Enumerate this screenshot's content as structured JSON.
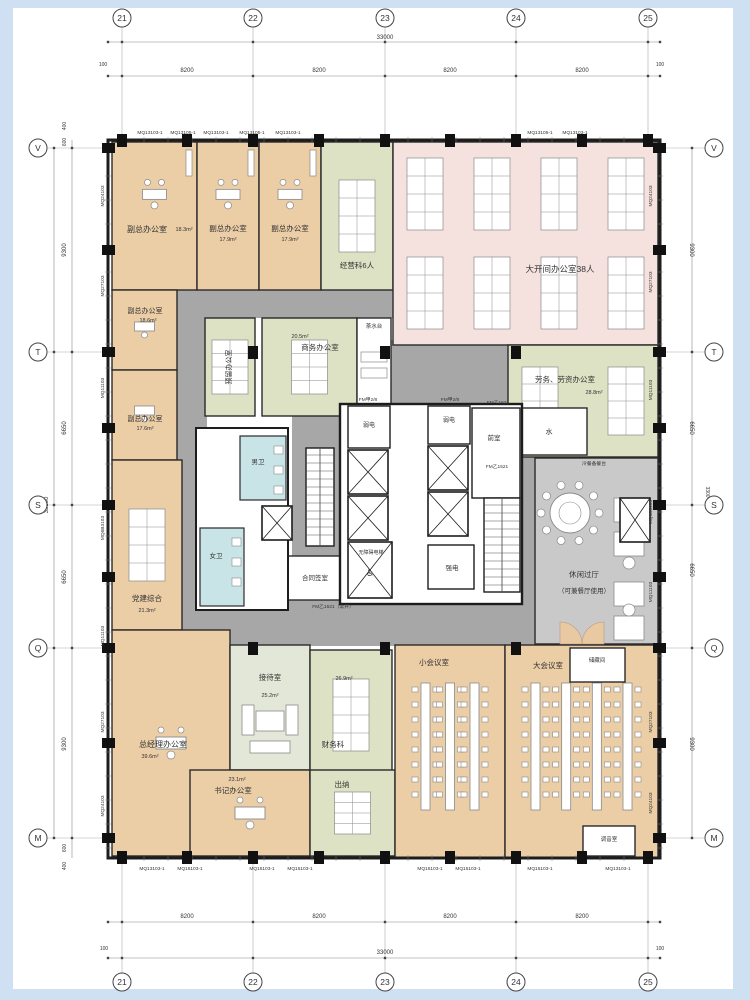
{
  "drawing": {
    "type": "architectural-floor-plan",
    "total_width_mm": "33000",
    "total_height_mm": "33100"
  },
  "colors": {
    "frame": "#cfe0f2",
    "sheet": "#ffffff",
    "wall": "#1d1d1d",
    "corridor": "#a7a7a7",
    "peach": "#ebcda6",
    "pink": "#f5e2df",
    "green": "#dce2c3",
    "sage": "#e3e7d7",
    "cyan": "#c9e4e7",
    "lightgray": "#c9c9c9",
    "white": "#ffffff",
    "dim": "#555555",
    "furn_stroke": "#8a8a8a",
    "door": "#e8c9a2"
  },
  "grid": {
    "cols": [
      {
        "l": "21",
        "x": 122
      },
      {
        "l": "22",
        "x": 253
      },
      {
        "l": "23",
        "x": 385
      },
      {
        "l": "24",
        "x": 516
      },
      {
        "l": "25",
        "x": 648
      }
    ],
    "rows": [
      {
        "l": "V",
        "y": 148
      },
      {
        "l": "T",
        "y": 352
      },
      {
        "l": "S",
        "y": 505
      },
      {
        "l": "Q",
        "y": 648
      },
      {
        "l": "M",
        "y": 838
      }
    ],
    "building": {
      "x": 108,
      "y": 140,
      "w": 552,
      "h": 718
    }
  },
  "dim_texts": [
    {
      "t": "33000",
      "x": 385,
      "y": 39,
      "s": 6
    },
    {
      "t": "100",
      "x": 103,
      "y": 66,
      "s": 5
    },
    {
      "t": "8200",
      "x": 187,
      "y": 72,
      "s": 6
    },
    {
      "t": "8200",
      "x": 319,
      "y": 72,
      "s": 6
    },
    {
      "t": "8200",
      "x": 450,
      "y": 72,
      "s": 6
    },
    {
      "t": "8200",
      "x": 582,
      "y": 72,
      "s": 6
    },
    {
      "t": "100",
      "x": 660,
      "y": 66,
      "s": 5
    },
    {
      "t": "8200",
      "x": 187,
      "y": 918,
      "s": 6
    },
    {
      "t": "8200",
      "x": 319,
      "y": 918,
      "s": 6
    },
    {
      "t": "8200",
      "x": 450,
      "y": 918,
      "s": 6
    },
    {
      "t": "8200",
      "x": 582,
      "y": 918,
      "s": 6
    },
    {
      "t": "33000",
      "x": 385,
      "y": 954,
      "s": 6
    },
    {
      "t": "100",
      "x": 104,
      "y": 950,
      "s": 5
    },
    {
      "t": "100",
      "x": 660,
      "y": 950,
      "s": 5
    },
    {
      "t": "400",
      "x": 66,
      "y": 126,
      "s": 5,
      "r": -90
    },
    {
      "t": "600",
      "x": 66,
      "y": 142,
      "s": 5,
      "r": -90
    },
    {
      "t": "9300",
      "x": 66,
      "y": 250,
      "s": 6,
      "r": -90
    },
    {
      "t": "6650",
      "x": 66,
      "y": 428,
      "s": 6,
      "r": -90
    },
    {
      "t": "6650",
      "x": 66,
      "y": 577,
      "s": 6,
      "r": -90
    },
    {
      "t": "9300",
      "x": 66,
      "y": 744,
      "s": 6,
      "r": -90
    },
    {
      "t": "600",
      "x": 66,
      "y": 848,
      "s": 5,
      "r": -90
    },
    {
      "t": "400",
      "x": 66,
      "y": 866,
      "s": 5,
      "r": -90
    },
    {
      "t": "33100",
      "x": 48,
      "y": 505,
      "s": 6,
      "r": -90
    },
    {
      "t": "9300",
      "x": 690,
      "y": 250,
      "s": 6,
      "r": 90
    },
    {
      "t": "6650",
      "x": 690,
      "y": 428,
      "s": 6,
      "r": 90
    },
    {
      "t": "3300",
      "x": 706,
      "y": 492,
      "s": 5,
      "r": 90
    },
    {
      "t": "6650",
      "x": 690,
      "y": 570,
      "s": 6,
      "r": 90
    },
    {
      "t": "9300",
      "x": 690,
      "y": 744,
      "s": 6,
      "r": 90
    }
  ],
  "window_tags": {
    "top": [
      {
        "t": "MQ13103-1",
        "x": 150
      },
      {
        "t": "MQ13105-1",
        "x": 183
      },
      {
        "t": "MQ13103-1",
        "x": 216
      },
      {
        "t": "MQ13105-1",
        "x": 252
      },
      {
        "t": "MQ13103-1",
        "x": 288
      },
      {
        "t": "MQ13105-1",
        "x": 540
      },
      {
        "t": "MQ13103-1",
        "x": 575
      }
    ],
    "bottom": [
      {
        "t": "MQ13103-1",
        "x": 152
      },
      {
        "t": "MQ15103-1",
        "x": 190
      },
      {
        "t": "MQ15103-1",
        "x": 262
      },
      {
        "t": "MQ15103-1",
        "x": 300
      },
      {
        "t": "MQ15103-1",
        "x": 430
      },
      {
        "t": "MQ15103-1",
        "x": 468
      },
      {
        "t": "MQ15103-1",
        "x": 540
      },
      {
        "t": "MQ13103-1",
        "x": 618
      }
    ],
    "left": [
      {
        "t": "MQ24103",
        "y": 196
      },
      {
        "t": "MQ27103",
        "y": 286
      },
      {
        "t": "MQ11103",
        "y": 388
      },
      {
        "t": "MQ6B3103",
        "y": 528
      },
      {
        "t": "MQ11103",
        "y": 636
      },
      {
        "t": "MQ27103",
        "y": 722
      },
      {
        "t": "MQ24103",
        "y": 806
      }
    ],
    "right": [
      {
        "t": "MQ24103",
        "y": 196
      },
      {
        "t": "MQ27103",
        "y": 282
      },
      {
        "t": "MQ11103",
        "y": 390
      },
      {
        "t": "MQ6B3103",
        "y": 512
      },
      {
        "t": "MQ11103",
        "y": 592
      },
      {
        "t": "MQ27103",
        "y": 722
      },
      {
        "t": "MQ24103",
        "y": 803
      }
    ]
  },
  "corridors": [
    {
      "x": 175,
      "y": 286,
      "w": 333,
      "h": 32
    },
    {
      "x": 177,
      "y": 286,
      "w": 30,
      "h": 350
    },
    {
      "x": 205,
      "y": 598,
      "w": 330,
      "h": 48
    },
    {
      "x": 390,
      "y": 340,
      "w": 44,
      "h": 266
    },
    {
      "x": 433,
      "y": 345,
      "w": 75,
      "h": 61
    },
    {
      "x": 292,
      "y": 406,
      "w": 48,
      "h": 196
    },
    {
      "x": 520,
      "y": 457,
      "w": 15,
      "h": 141
    }
  ],
  "rooms": [
    {
      "id": "fuzong-a",
      "f": "peach",
      "x": 112,
      "y": 142,
      "w": 85,
      "h": 148,
      "furn": "exec",
      "labels": [
        {
          "t": "副总办公室",
          "x": 147,
          "y": 232,
          "s": 8
        },
        {
          "t": "18.3m²",
          "x": 184,
          "y": 231,
          "s": 5.5
        }
      ]
    },
    {
      "id": "fuzong-b",
      "f": "peach",
      "x": 197,
      "y": 142,
      "w": 62,
      "h": 148,
      "furn": "exec",
      "labels": [
        {
          "t": "副总办公室",
          "x": 228,
          "y": 231,
          "s": 7.5
        },
        {
          "t": "17.9m²",
          "x": 228,
          "y": 241,
          "s": 5.5
        }
      ]
    },
    {
      "id": "fuzong-c",
      "f": "peach",
      "x": 259,
      "y": 142,
      "w": 62,
      "h": 148,
      "furn": "exec",
      "labels": [
        {
          "t": "副总办公室",
          "x": 290,
          "y": 231,
          "s": 7.5
        },
        {
          "t": "17.9m²",
          "x": 290,
          "y": 241,
          "s": 5.5
        }
      ]
    },
    {
      "id": "jingyingke",
      "f": "green",
      "x": 321,
      "y": 142,
      "w": 72,
      "h": 148,
      "furn": "ws",
      "labels": [
        {
          "t": "经营科6人",
          "x": 357,
          "y": 268,
          "s": 7.5
        }
      ]
    },
    {
      "id": "dakaijian",
      "f": "pink",
      "x": 393,
      "y": 142,
      "w": 265,
      "h": 203,
      "furn": "ws",
      "labels": [
        {
          "t": "大开间办公室38人",
          "x": 560,
          "y": 272,
          "s": 8.5
        }
      ]
    },
    {
      "id": "fuzong-d",
      "f": "peach",
      "x": 112,
      "y": 290,
      "w": 65,
      "h": 80,
      "furn": "exec2",
      "labels": [
        {
          "t": "副总办公室",
          "x": 145,
          "y": 313,
          "s": 7
        },
        {
          "t": "18.6m²",
          "x": 148,
          "y": 322,
          "s": 5.5
        }
      ]
    },
    {
      "id": "fuzong-e",
      "f": "peach",
      "x": 112,
      "y": 370,
      "w": 65,
      "h": 90,
      "furn": "exec2",
      "labels": [
        {
          "t": "副总办公室",
          "x": 145,
          "y": 421,
          "s": 7
        },
        {
          "t": "17.6m²",
          "x": 145,
          "y": 430,
          "s": 5.5
        }
      ]
    },
    {
      "id": "yuliu",
      "f": "green",
      "x": 205,
      "y": 318,
      "w": 50,
      "h": 98,
      "furn": "ws",
      "labels": [
        {
          "t": "预留办公室",
          "x": 231,
          "y": 367,
          "s": 7,
          "r": -90
        }
      ]
    },
    {
      "id": "shangwu",
      "f": "green",
      "x": 262,
      "y": 318,
      "w": 95,
      "h": 98,
      "furn": "ws",
      "labels": [
        {
          "t": "20.5m²",
          "x": 300,
          "y": 338,
          "s": 5.5
        },
        {
          "t": "商务办公室",
          "x": 320,
          "y": 350,
          "s": 7.5
        }
      ]
    },
    {
      "id": "chashuitai",
      "f": "white",
      "x": 357,
      "y": 318,
      "w": 34,
      "h": 87,
      "furn": "tea",
      "labels": [
        {
          "t": "茶水台",
          "x": 374,
          "y": 328,
          "s": 5.5
        }
      ]
    },
    {
      "id": "laowu",
      "f": "green",
      "x": 508,
      "y": 345,
      "w": 150,
      "h": 112,
      "furn": "ws",
      "labels": [
        {
          "t": "劳务、劳资办公室",
          "x": 565,
          "y": 382,
          "s": 7.5
        },
        {
          "t": "28.8m²",
          "x": 594,
          "y": 394,
          "s": 5.5
        }
      ]
    },
    {
      "id": "shui",
      "f": "white",
      "x": 512,
      "y": 408,
      "w": 75,
      "h": 47,
      "furn": null,
      "labels": [
        {
          "t": "水",
          "x": 549,
          "y": 434,
          "s": 7
        }
      ]
    },
    {
      "id": "dangjian",
      "f": "peach",
      "x": 112,
      "y": 460,
      "w": 70,
      "h": 170,
      "furn": "ws",
      "labels": [
        {
          "t": "党建综合",
          "x": 147,
          "y": 601,
          "s": 7.5
        },
        {
          "t": "21.3m²",
          "x": 147,
          "y": 612,
          "s": 5.5
        }
      ]
    },
    {
      "id": "hetong",
      "f": "white",
      "x": 286,
      "y": 556,
      "w": 58,
      "h": 44,
      "furn": null,
      "labels": [
        {
          "t": "合同签室",
          "x": 315,
          "y": 580,
          "s": 6.5
        }
      ]
    },
    {
      "id": "nvwei",
      "f": "cyan",
      "x": 200,
      "y": 528,
      "w": 44,
      "h": 78,
      "furn": "wc",
      "labels": [
        {
          "t": "女卫",
          "x": 216,
          "y": 558,
          "s": 6.5
        }
      ]
    },
    {
      "id": "nanwei",
      "f": "cyan",
      "x": 240,
      "y": 436,
      "w": 46,
      "h": 64,
      "furn": "wc",
      "labels": [
        {
          "t": "男卫",
          "x": 258,
          "y": 464,
          "s": 6.5
        }
      ]
    },
    {
      "id": "xiuxian",
      "f": "lightgray",
      "x": 535,
      "y": 458,
      "w": 123,
      "h": 186,
      "furn": "lounge",
      "labels": [
        {
          "t": "休闲过厅",
          "x": 584,
          "y": 577,
          "s": 7.5
        },
        {
          "t": "（可兼餐厅使用）",
          "x": 584,
          "y": 593,
          "s": 6.5
        }
      ]
    },
    {
      "id": "zongjingli",
      "f": "peach",
      "x": 112,
      "y": 630,
      "w": 118,
      "h": 226,
      "furn": "bigdesk",
      "labels": [
        {
          "t": "总经理办公室",
          "x": 163,
          "y": 747,
          "s": 8
        },
        {
          "t": "39.6m²",
          "x": 150,
          "y": 758,
          "s": 5.5
        }
      ]
    },
    {
      "id": "jiedai",
      "f": "sage",
      "x": 230,
      "y": 645,
      "w": 80,
      "h": 125,
      "furn": "recept",
      "labels": [
        {
          "t": "接待室",
          "x": 270,
          "y": 680,
          "s": 7.5
        },
        {
          "t": "25.2m²",
          "x": 270,
          "y": 697,
          "s": 5.5
        }
      ]
    },
    {
      "id": "shuji",
      "f": "peach",
      "x": 190,
      "y": 770,
      "w": 120,
      "h": 86,
      "furn": "bigdesk",
      "labels": [
        {
          "t": "23.1m²",
          "x": 237,
          "y": 781,
          "s": 5.5
        },
        {
          "t": "书记办公室",
          "x": 233,
          "y": 793,
          "s": 7.5
        }
      ]
    },
    {
      "id": "caiwu",
      "f": "green",
      "x": 310,
      "y": 650,
      "w": 82,
      "h": 130,
      "furn": "ws",
      "labels": [
        {
          "t": "26.9m²",
          "x": 344,
          "y": 680,
          "s": 5.5
        },
        {
          "t": "财务科",
          "x": 333,
          "y": 747,
          "s": 7.5
        }
      ]
    },
    {
      "id": "chuna",
      "f": "green",
      "x": 310,
      "y": 770,
      "w": 85,
      "h": 86,
      "furn": "ws",
      "labels": [
        {
          "t": "出纳",
          "x": 342,
          "y": 787,
          "s": 7.5
        }
      ]
    },
    {
      "id": "xiaohuiyishi",
      "f": "peach",
      "x": 395,
      "y": 645,
      "w": 110,
      "h": 213,
      "furn": "meeting",
      "labels": [
        {
          "t": "小会议室",
          "x": 434,
          "y": 665,
          "s": 7.5
        }
      ]
    },
    {
      "id": "dahuiyishi",
      "f": "peach",
      "x": 505,
      "y": 645,
      "w": 153,
      "h": 213,
      "furn": "meeting",
      "labels": [
        {
          "t": "大会议室",
          "x": 548,
          "y": 668,
          "s": 7.5
        }
      ]
    },
    {
      "id": "chucang",
      "f": "white",
      "x": 570,
      "y": 648,
      "w": 55,
      "h": 34,
      "furn": null,
      "labels": [
        {
          "t": "储藏间",
          "x": 597,
          "y": 662,
          "s": 5.5
        }
      ]
    },
    {
      "id": "tiaoyin",
      "f": "white",
      "x": 583,
      "y": 826,
      "w": 52,
      "h": 30,
      "furn": null,
      "labels": [
        {
          "t": "调音室",
          "x": 609,
          "y": 841,
          "s": 5.5
        }
      ]
    }
  ],
  "core": {
    "outline": {
      "x": 340,
      "y": 404,
      "w": 182,
      "h": 200
    },
    "toilet_outline": {
      "x": 196,
      "y": 428,
      "w": 92,
      "h": 182
    },
    "white_rooms": [
      {
        "x": 348,
        "y": 406,
        "w": 42,
        "h": 42
      },
      {
        "x": 428,
        "y": 406,
        "w": 42,
        "h": 38
      },
      {
        "x": 472,
        "y": 408,
        "w": 48,
        "h": 90
      },
      {
        "x": 428,
        "y": 545,
        "w": 46,
        "h": 44
      }
    ],
    "elevators": [
      {
        "x": 348,
        "y": 450,
        "w": 40,
        "h": 44
      },
      {
        "x": 348,
        "y": 496,
        "w": 40,
        "h": 44
      },
      {
        "x": 428,
        "y": 446,
        "w": 40,
        "h": 44
      },
      {
        "x": 428,
        "y": 492,
        "w": 40,
        "h": 44
      },
      {
        "x": 262,
        "y": 506,
        "w": 30,
        "h": 34
      },
      {
        "x": 620,
        "y": 498,
        "w": 30,
        "h": 44
      },
      {
        "x": 348,
        "y": 542,
        "w": 44,
        "h": 56,
        "accessible": true
      }
    ],
    "stairs": [
      {
        "x": 306,
        "y": 448,
        "w": 28,
        "h": 98
      },
      {
        "x": 484,
        "y": 498,
        "w": 36,
        "h": 94
      }
    ],
    "labels": [
      {
        "t": "FM甲2/8",
        "x": 368,
        "y": 401,
        "s": 4.8
      },
      {
        "t": "弱电",
        "x": 369,
        "y": 427,
        "s": 6
      },
      {
        "t": "FM甲2/8",
        "x": 450,
        "y": 401,
        "s": 4.8
      },
      {
        "t": "弱电",
        "x": 449,
        "y": 422,
        "s": 6
      },
      {
        "t": "FM乙1521",
        "x": 498,
        "y": 404,
        "s": 4.8
      },
      {
        "t": "前室",
        "x": 494,
        "y": 440,
        "s": 6.5
      },
      {
        "t": "FM乙1521",
        "x": 497,
        "y": 468,
        "s": 4.8
      },
      {
        "t": "强电",
        "x": 452,
        "y": 570,
        "s": 6.5
      },
      {
        "t": "无障碍电梯",
        "x": 371,
        "y": 554,
        "s": 5
      },
      {
        "t": "♿",
        "x": 370,
        "y": 576,
        "s": 9
      },
      {
        "t": "FM乙1521（常开）",
        "x": 333,
        "y": 608,
        "s": 4.8
      },
      {
        "t": "冷餐备餐台",
        "x": 594,
        "y": 465,
        "s": 4.8
      }
    ]
  },
  "doors_double": [
    {
      "x": 560,
      "y": 644
    },
    {
      "x": 604,
      "y": 644
    }
  ],
  "interior_columns": [
    {
      "x": 253,
      "y": 352
    },
    {
      "x": 385,
      "y": 352
    },
    {
      "x": 516,
      "y": 352
    },
    {
      "x": 253,
      "y": 648
    },
    {
      "x": 385,
      "y": 648
    },
    {
      "x": 516,
      "y": 648
    }
  ],
  "facade_column_xs": [
    122,
    187,
    253,
    319,
    385,
    450,
    516,
    582,
    648
  ],
  "facade_column_ys": [
    148,
    250,
    352,
    428,
    505,
    577,
    648,
    743,
    838
  ]
}
